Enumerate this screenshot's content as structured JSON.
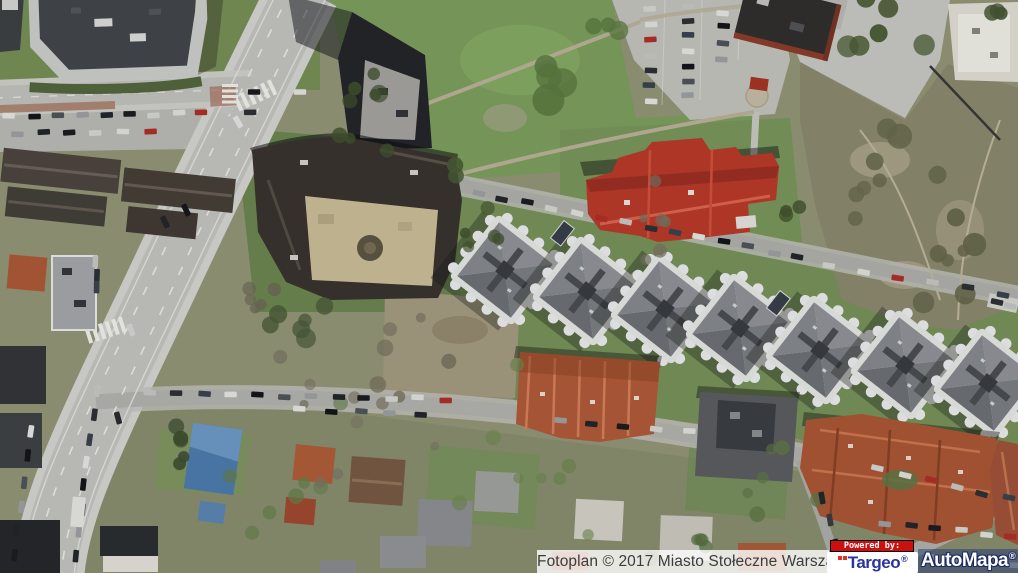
{
  "map": {
    "view_type": "satellite-photo"
  },
  "footer": {
    "attribution": "Fotoplan © 2017 Miasto Stołeczne Warszawa",
    "powered_by_label": "Powered by:",
    "targeo_brand": "Targeo",
    "automapa_brand": "AutoMapa",
    "registered_symbol": "®",
    "colors": {
      "powered_by_bg": "#cc1010",
      "powered_by_text": "#ffffff",
      "targeo_text": "#2a35a0",
      "targeo_dots": "#e03222",
      "automapa_text": "#ffffff",
      "automapa_bg": "rgba(35,55,110,0.5)",
      "automapa_outline": "#1c2a66",
      "attribution_text": "#3c3c3c",
      "attribution_bg": "rgba(255,255,255,0.8)"
    }
  }
}
